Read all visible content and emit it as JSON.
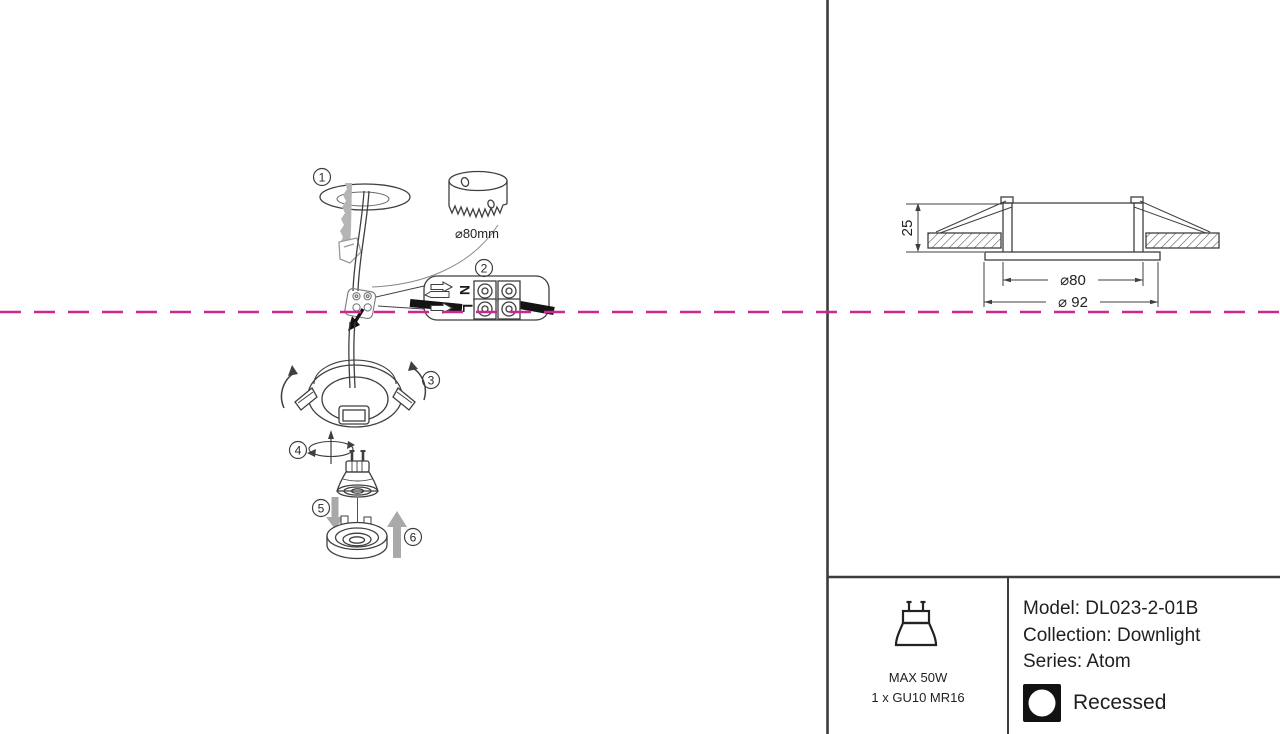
{
  "colors": {
    "magenta": "#c9288f",
    "line": "#3f3f3f",
    "gray_arrow": "#a9a9a9",
    "wire_black": "#141414"
  },
  "install": {
    "steps": [
      "1",
      "2",
      "3",
      "4",
      "5",
      "6"
    ],
    "hole_diameter_label": "⌀80mm",
    "terminal": {
      "neutral_label": "N",
      "live_label": "L"
    }
  },
  "dimension_drawing": {
    "height_mm": "25",
    "cutout_diameter": "⌀80",
    "outer_diameter": "⌀ 92"
  },
  "spec": {
    "wattage": "MAX 50W",
    "lamp_count_type": "1 x GU10 MR16",
    "model_line": "Model: DL023-2-01B",
    "collection_line": "Collection: Downlight",
    "series_line": "Series: Atom",
    "mounting": "Recessed"
  }
}
